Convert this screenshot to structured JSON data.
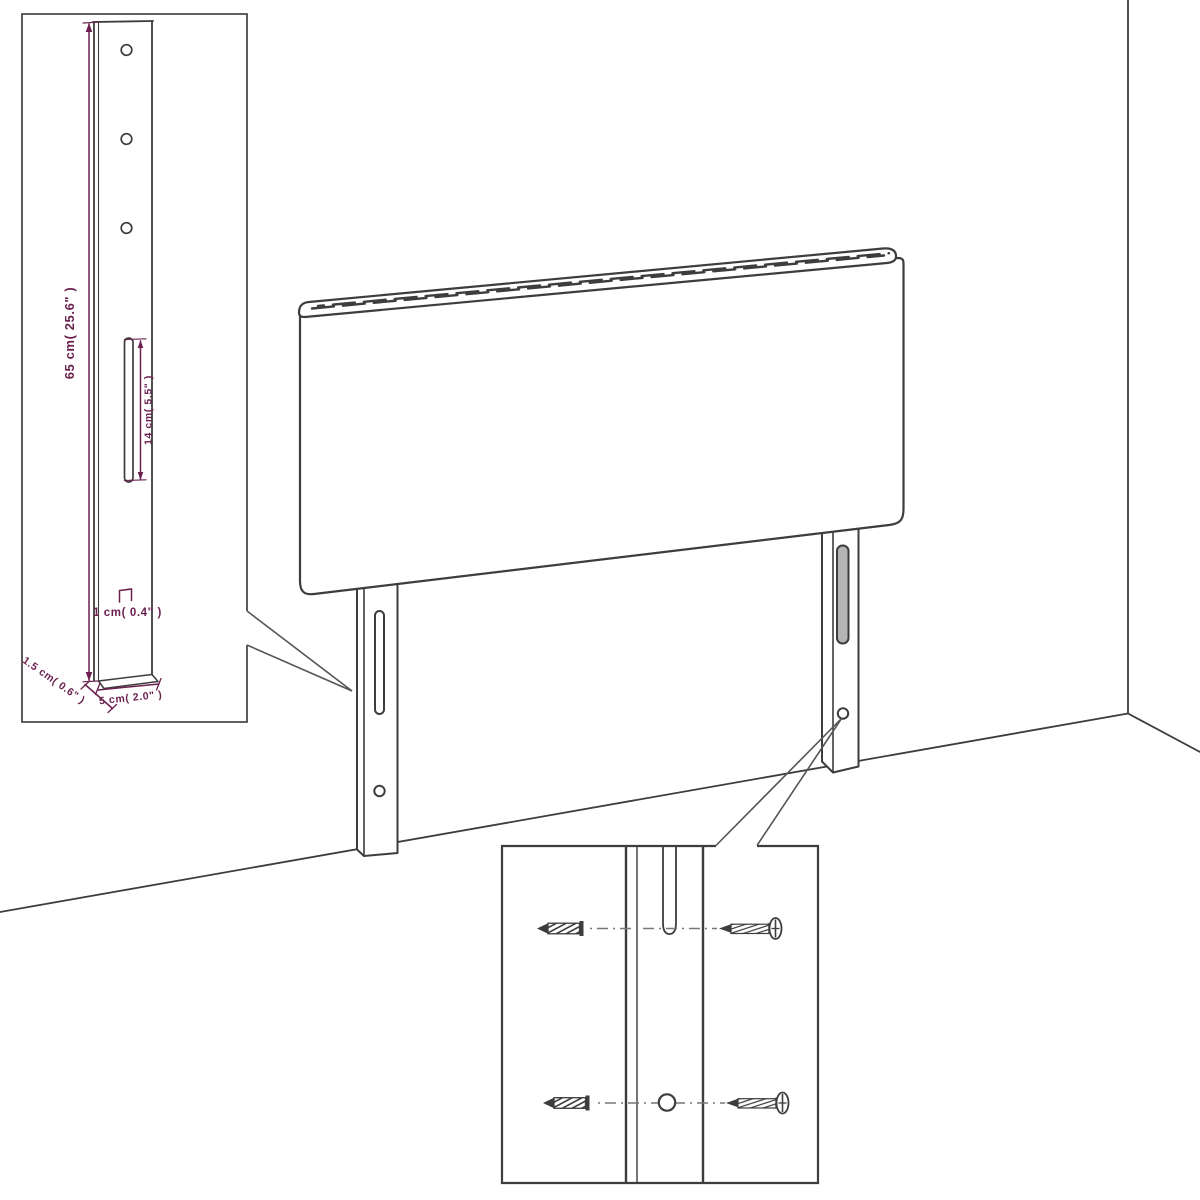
{
  "diagram": {
    "colors": {
      "line": "#3d3d3d",
      "dimension_text": "#6b2150",
      "slot_fill": "#b5b5b5",
      "background": "#ffffff"
    },
    "leg_detail_inset": {
      "labels": {
        "leg_height": "65 cm( 25.6\" )",
        "slot_length": "14 cm( 5.5\" )",
        "hole_offset": "1 cm( 0.4\" )",
        "leg_depth": "1.5 cm( 0.6\" )",
        "leg_width": "5 cm( 2.0\" )"
      }
    },
    "hardware_inset": {
      "icons": [
        "wall-plug-icon",
        "screw-icon",
        "mounting-slot",
        "mounting-hole"
      ]
    }
  }
}
